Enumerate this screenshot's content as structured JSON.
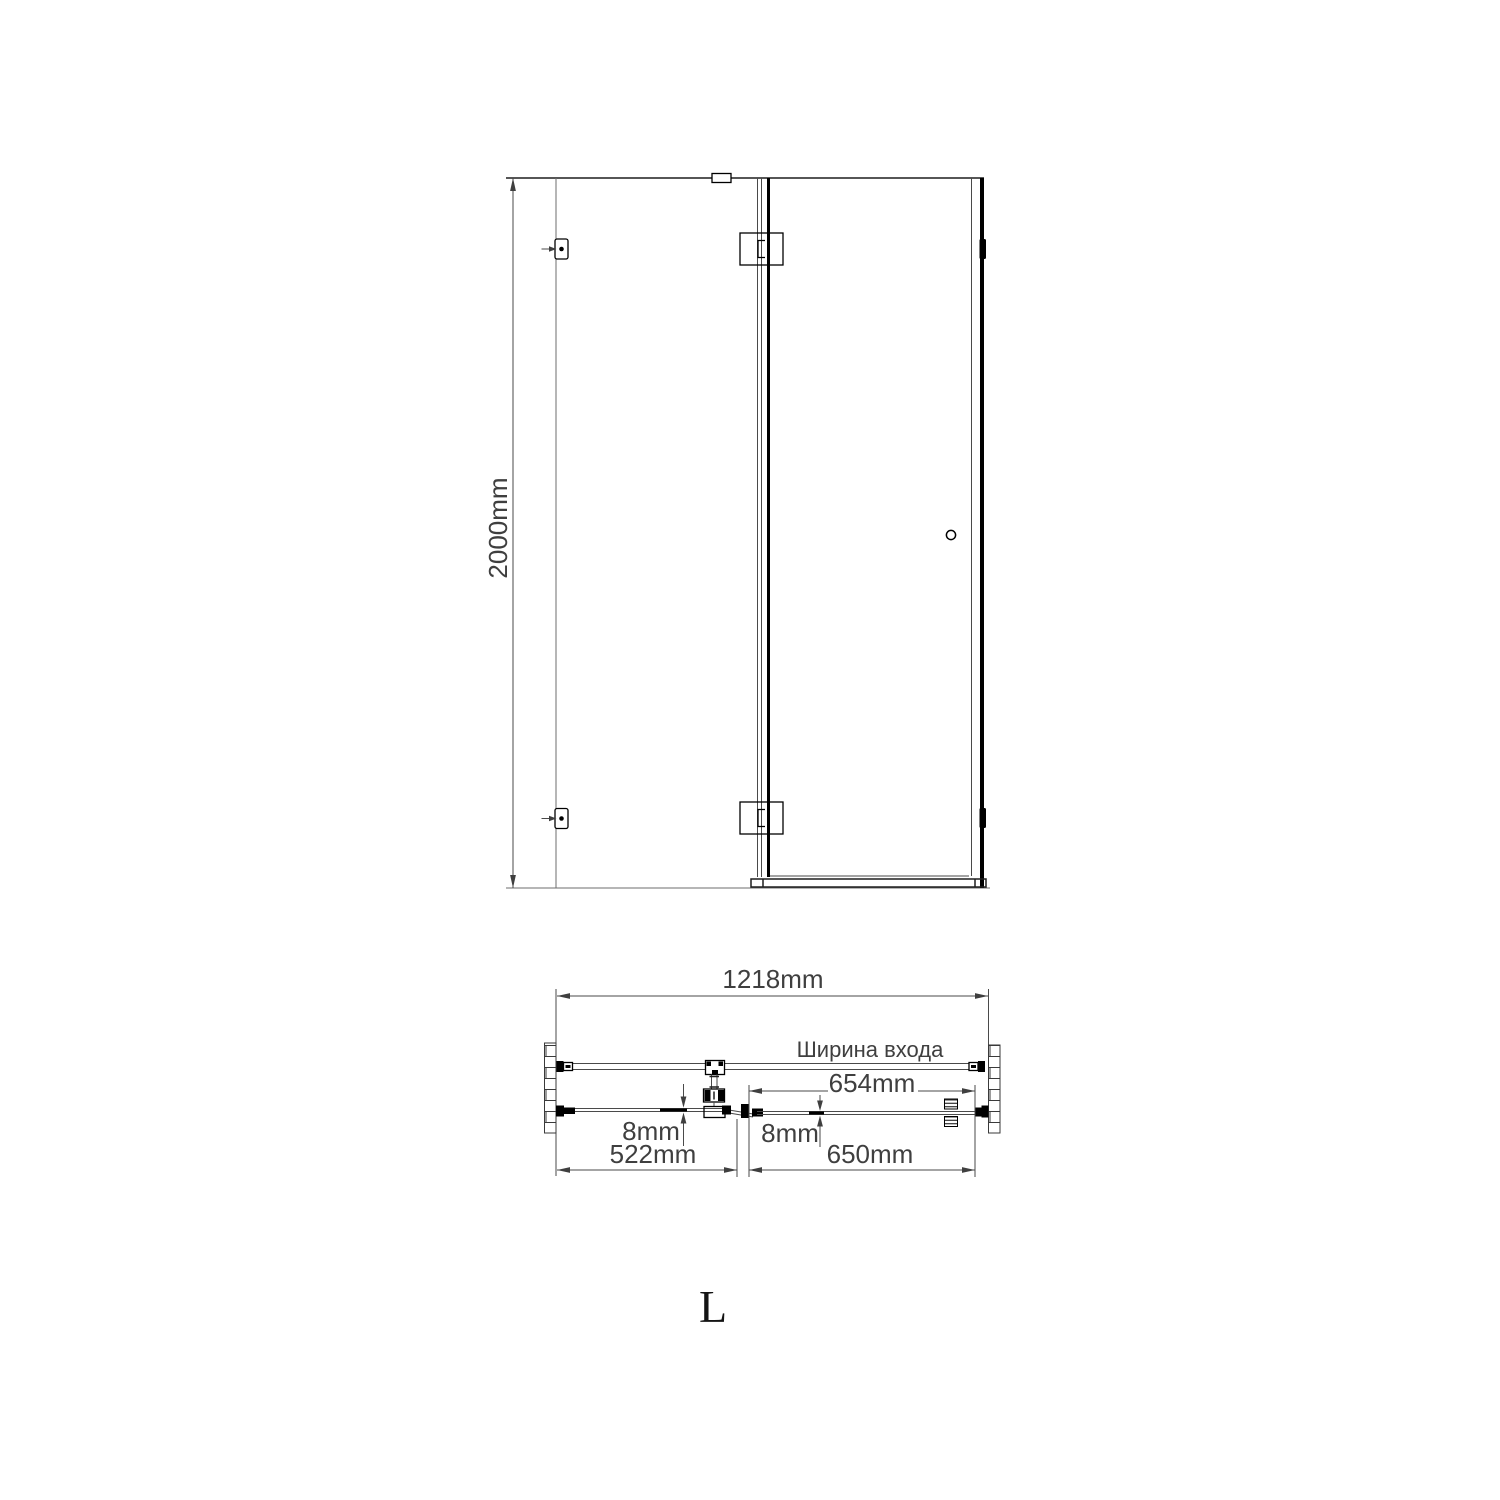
{
  "front_view": {
    "height": "2000mm"
  },
  "plan_view": {
    "total_width": "1218mm",
    "entrance_width_label": "Ширина входа",
    "entrance_width": "654mm",
    "fixed_glass_thickness": "8mm",
    "door_glass_thickness": "8mm",
    "fixed_panel_width": "522mm",
    "door_width": "650mm"
  },
  "orientation": {
    "letter": "L"
  },
  "colors": {
    "background": "#ffffff",
    "line": "#4a4a4a",
    "fitting": "#000000",
    "text": "#3f3f3f"
  }
}
